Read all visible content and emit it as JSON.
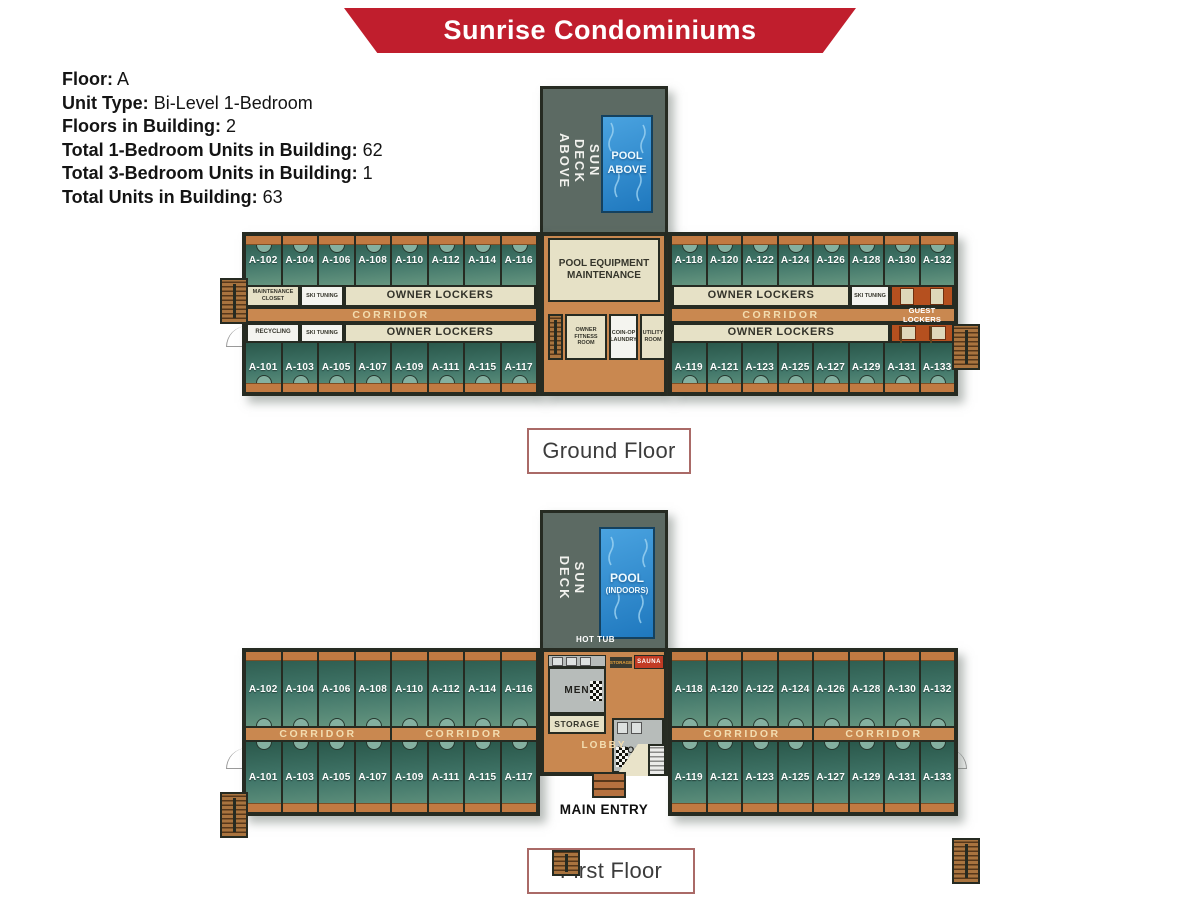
{
  "banner": {
    "title": "Sunrise Condominiums",
    "color": "#c01e2d"
  },
  "info": {
    "lines": [
      {
        "label": "Floor:",
        "value": "A"
      },
      {
        "label": "Unit Type:",
        "value": "Bi-Level 1-Bedroom"
      },
      {
        "label": "Floors in Building:",
        "value": "2"
      },
      {
        "label": "Total 1-Bedroom Units in Building:",
        "value": "62"
      },
      {
        "label": "Total 3-Bedroom Units in Building:",
        "value": "1"
      },
      {
        "label": "Total Units in Building:",
        "value": "63"
      }
    ]
  },
  "ground_floor": {
    "caption": "Ground Floor",
    "sun_deck": "SUN DECK\nABOVE",
    "pool": "POOL\nABOVE",
    "pool_equipment": "POOL EQUIPMENT MAINTENANCE",
    "owner_fitness": "OWNER FITNESS ROOM",
    "coin_op_laundry": "COIN-OP LAUNDRY",
    "utility_room": "UTILITY ROOM",
    "maintenance_closet": "MAINTENANCE CLOSET",
    "ski_tuning": "SKI TUNING",
    "recycling": "RECYCLING",
    "owner_lockers": "OWNER LOCKERS",
    "guest_lockers": "GUEST LOCKERS",
    "corridor": "CORRIDOR",
    "units": {
      "left_top": [
        "A-102",
        "A-104",
        "A-106",
        "A-108",
        "A-110",
        "A-112",
        "A-114",
        "A-116"
      ],
      "left_bottom": [
        "A-101",
        "A-103",
        "A-105",
        "A-107",
        "A-109",
        "A-111",
        "A-115",
        "A-117"
      ],
      "right_top": [
        "A-118",
        "A-120",
        "A-122",
        "A-124",
        "A-126",
        "A-128",
        "A-130",
        "A-132"
      ],
      "right_bottom": [
        "A-119",
        "A-121",
        "A-123",
        "A-125",
        "A-127",
        "A-129",
        "A-131",
        "A-133"
      ]
    }
  },
  "first_floor": {
    "caption": "First Floor",
    "sun_deck": "SUN DECK",
    "pool_line1": "POOL",
    "pool_line2": "(INDOORS)",
    "hot_tub": "HOT TUB",
    "men": "MEN",
    "women": "WOMEN",
    "storage": "STORAGE",
    "storage_small": "STORAGE",
    "sauna": "SAUNA",
    "lobby": "LOBBY",
    "main_entry": "MAIN ENTRY",
    "corridor": "CORRIDOR",
    "units": {
      "left_top": [
        "A-102",
        "A-104",
        "A-106",
        "A-108",
        "A-110",
        "A-112",
        "A-114",
        "A-116"
      ],
      "left_bottom": [
        "A-101",
        "A-103",
        "A-105",
        "A-107",
        "A-109",
        "A-111",
        "A-115",
        "A-117"
      ],
      "right_top": [
        "A-118",
        "A-120",
        "A-122",
        "A-124",
        "A-126",
        "A-128",
        "A-130",
        "A-132"
      ],
      "right_bottom": [
        "A-119",
        "A-121",
        "A-123",
        "A-125",
        "A-127",
        "A-129",
        "A-131",
        "A-133"
      ]
    }
  },
  "colors": {
    "banner_red": "#c01e2d",
    "unit_green_dark": "#2a584b",
    "unit_green_light": "#65957f",
    "corridor_orange": "#c98850",
    "balcony_orange": "#c17a42",
    "locker_beige": "#e6e1c6",
    "guest_locker_red": "#b5501f",
    "pool_blue": "#1f78be",
    "sun_deck_gray": "#5c6a63",
    "wall_dark": "#262b22",
    "restroom_gray": "#b7bcba",
    "sauna_red": "#c23b24"
  }
}
